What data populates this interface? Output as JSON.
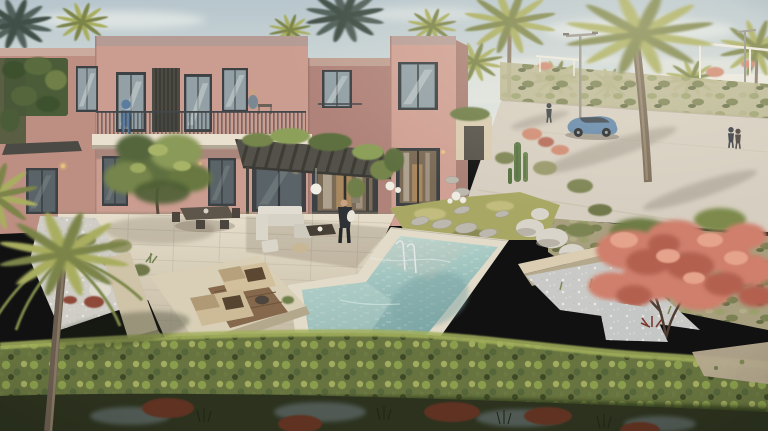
{
  "meta": {
    "content_type": "3d-architectural-rendering",
    "subject": "Aerial view of a two-storey terracotta townhouse villa with private L-shaped pool, pergola terrace, sun loungers and desert landscaping",
    "setting": "Resort community street with date palms, flowering tree, parked car and pedestrians"
  },
  "palette": {
    "sky_top": "#b7c6cd",
    "sky_horizon": "#e9eae2",
    "cloud": "#f4f5f1",
    "wall_lit": "#cb9d90",
    "wall_mid": "#bd8e82",
    "wall_shadow": "#b0837a",
    "wall_right": "#cfa093",
    "parapet": "#b49b94",
    "frame_dark": "#3d4143",
    "glass_cool": "#93a1a6",
    "glass_dark": "#5a6468",
    "glass_warm": "#7b6a55",
    "pergola": "#53514a",
    "balcony_slab": "#e9e0cf",
    "paving_light": "#e6decb",
    "paving_dark": "#c3b8a2",
    "pool_coping": "#e3dbc9",
    "water_light": "#c2dcd4",
    "water_deep": "#7fa8a8",
    "gravel": "#cfcdc6",
    "boulder": "#d8d4c9",
    "planter_wall": "#dacdb2",
    "grass": "#a8a864",
    "hedge_light": "#a3b05c",
    "hedge_mid": "#67743f",
    "hedge_dark": "#323c1f",
    "palm_frond": "#7c8448",
    "palm_frond_light": "#a8ad5e",
    "palm_trunk": "#6a5d4f",
    "flower_light": "#cf7f6c",
    "flower_deep": "#b3604f",
    "red_plant": "#8e4a38",
    "rust_plant": "#5e3122",
    "road": "#d6cec0",
    "car_body": "#6589ab",
    "foreground": "#2c321e",
    "sand_shadow": "#6e7a80",
    "sand_path": "#b5a88e",
    "ivy": "#4a5c38",
    "lamp_warm": "#e7c27c",
    "white_decor": "#efece4",
    "tree_green": "#5f7040"
  },
  "scene": {
    "building": {
      "storeys": 2,
      "facade_blocks": 4,
      "people_on_balconies": 2,
      "pergola": true,
      "ivy_wall": true
    },
    "pool": {
      "shape": "L-shaped",
      "ladder": true
    },
    "terrace": {
      "sun_loungers": 2,
      "people": 1,
      "dining_set": true,
      "lounge_set": true
    },
    "street": {
      "cars": 1,
      "street_lamps": 2,
      "pedestrians": 3
    },
    "vegetation": {
      "foreground_palm": 1,
      "large_palms_right": 2,
      "flowering_tree": 1,
      "boundary_hedge": true,
      "courtyard_tree": 1
    }
  }
}
